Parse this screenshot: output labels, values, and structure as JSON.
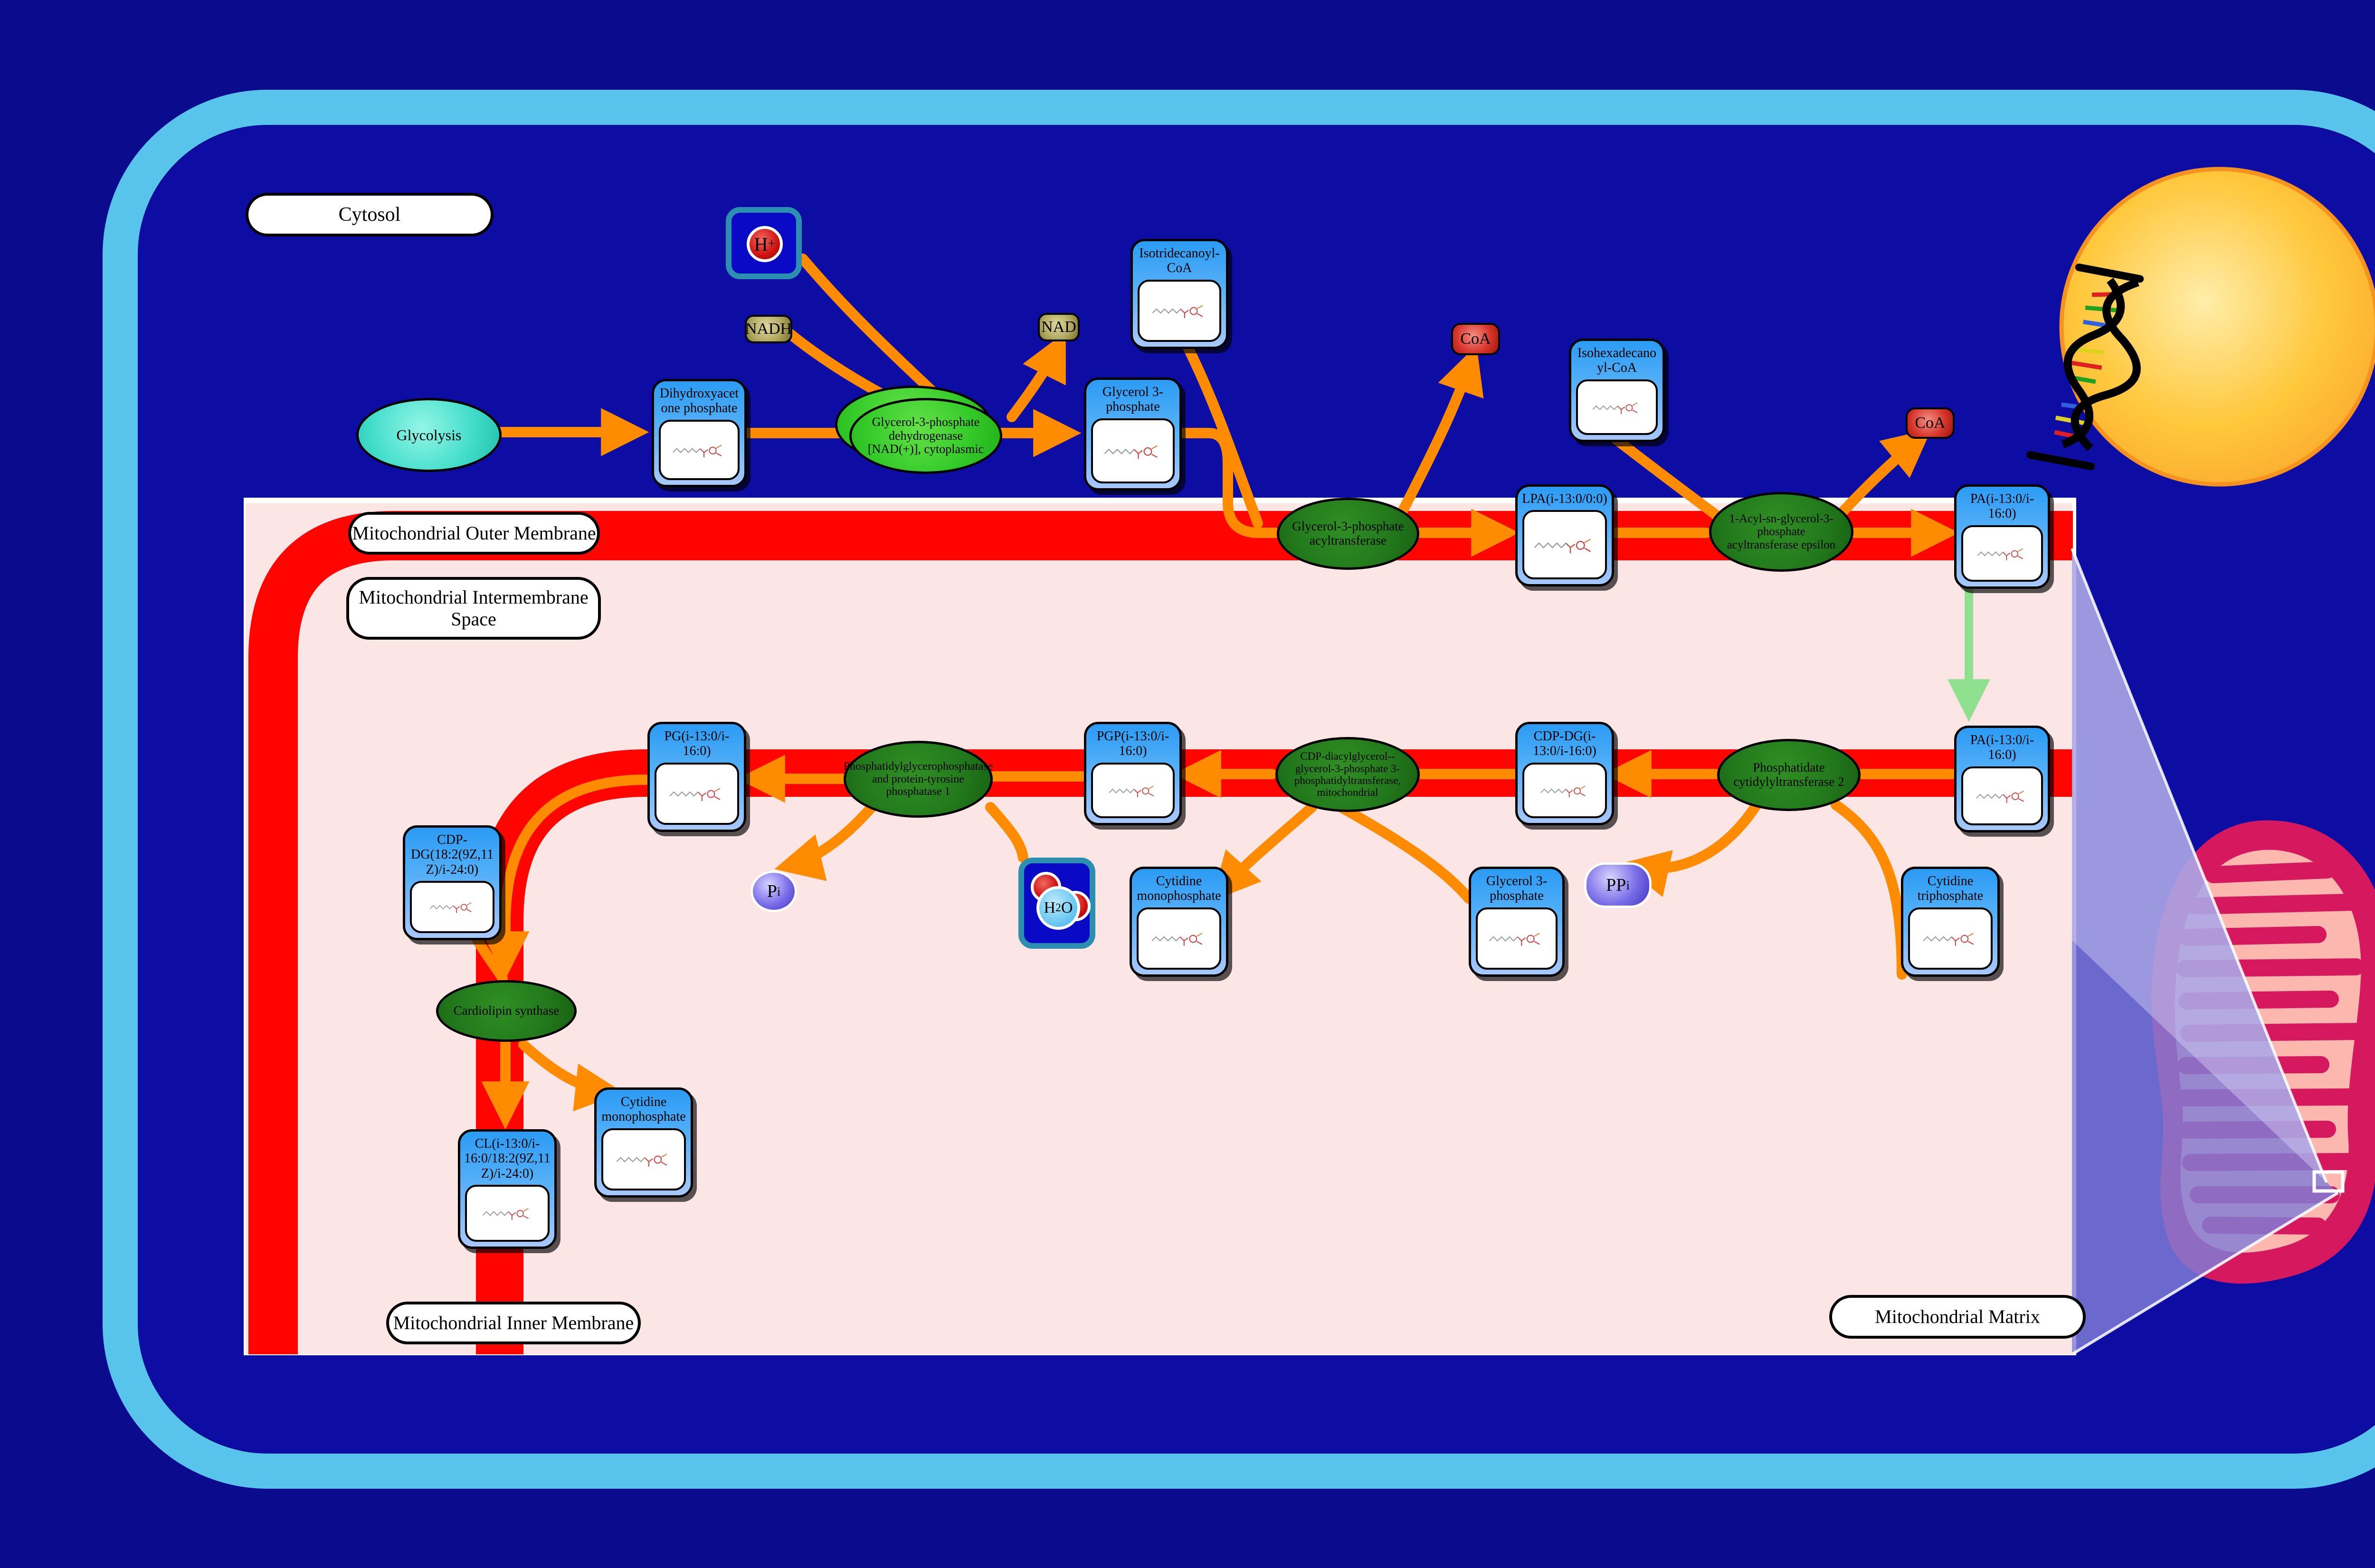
{
  "compartments": {
    "cytosol": "Cytosol",
    "outer_membrane": "Mitochondrial Outer Membrane",
    "intermembrane_space": "Mitochondrial Intermembrane Space",
    "inner_membrane": "Mitochondrial Inner Membrane",
    "matrix": "Mitochondrial Matrix"
  },
  "process": {
    "glycolysis": "Glycolysis"
  },
  "metabolites": [
    {
      "label": "Dihydroxyacetone phosphate"
    },
    {
      "label": "Glycerol 3-phosphate"
    },
    {
      "label": "Isotridecanoyl-CoA"
    },
    {
      "label": "Isohexadecanoyl-CoA"
    },
    {
      "label": "LPA(i-13:0/0:0)"
    },
    {
      "label": "PA(i-13:0/i-16:0)"
    },
    {
      "label": "PA(i-13:0/i-16:0)"
    },
    {
      "label": "CDP-DG(i-13:0/i-16:0)"
    },
    {
      "label": "PGP(i-13:0/i-16:0)"
    },
    {
      "label": "PG(i-13:0/i-16:0)"
    },
    {
      "label": "CDP-DG(18:2(9Z,11Z)/i-24:0)"
    },
    {
      "label": "Cytidine monophosphate"
    },
    {
      "label": "Glycerol 3-phosphate"
    },
    {
      "label": "Cytidine triphosphate"
    },
    {
      "label": "Cytidine monophosphate"
    },
    {
      "label": "CL(i-13:0/i-16:0/18:2(9Z,11Z)/i-24:0)"
    }
  ],
  "enzymes": [
    {
      "label": "Glycerol-3-phosphate dehydrogenase [NAD(+)], cytoplasmic"
    },
    {
      "label": "Glycerol-3-phosphate acyltransferase"
    },
    {
      "label": "1-Acyl-sn-glycerol-3-phosphate acyltransferase epsilon"
    },
    {
      "label": "Phosphatidate cytidylyltransferase 2"
    },
    {
      "label": "CDP-diacylglycerol--glycerol-3-phosphate 3-phosphatidyltransferase, mitochondrial"
    },
    {
      "label": "Phosphatidylglycerophosphatase and protein-tyrosine phosphatase 1"
    },
    {
      "label": "Cardiolipin synthase"
    }
  ],
  "small_molecules": {
    "nadh": "NADH",
    "nad": "NAD",
    "coa1": "CoA",
    "coa2": "CoA",
    "h_plus": {
      "base": "H",
      "sup": "+"
    },
    "h2o": {
      "h": "H",
      "sub": "2",
      "o": "O"
    },
    "pi": {
      "base": "P",
      "sub": "i"
    },
    "ppi": {
      "base": "PP",
      "sub": "i"
    }
  },
  "colors": {
    "background_navy": "#0b0b8e",
    "cell_border_sky": "#58c4ec",
    "membrane_red": "#ff0400",
    "compartment_pink": "#fbe5e5",
    "arrow_orange": "#ff8c00",
    "transport_arrow_green": "#8fe08f",
    "enzyme_green": "#237a1c",
    "enzyme_bright_green": "#35cb2a",
    "metabolite_blue": "#2b9bf4",
    "nucleus_yellow": "#ffc83d",
    "mitochondrion_crimson": "#d6195f",
    "mitochondrion_salmon": "#fcb7ae"
  }
}
